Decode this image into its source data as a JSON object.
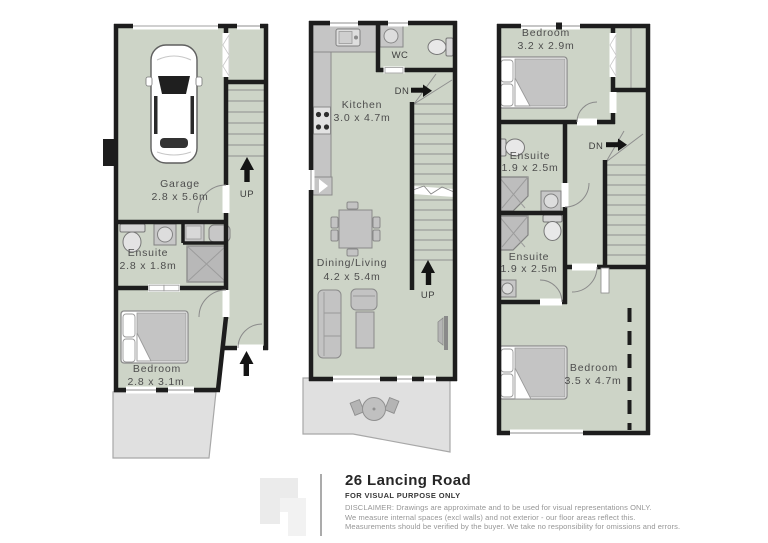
{
  "colors": {
    "room_fill": "#cdd4c7",
    "wall": "#1d1d1d",
    "deck_fill": "#e0e0e0",
    "furniture": "#c3c3c3",
    "label_text": "#4d4d4d"
  },
  "plans": {
    "ground": {
      "garage": {
        "name": "Garage",
        "dims": "2.8 x 5.6m"
      },
      "ensuite": {
        "name": "Ensuite",
        "dims": "2.8 x 1.8m"
      },
      "bedroom": {
        "name": "Bedroom",
        "dims": "2.8 x 3.1m"
      },
      "up_label": "UP"
    },
    "first": {
      "wc_label": "WC",
      "kitchen": {
        "name": "Kitchen",
        "dims": "3.0 x 4.7m"
      },
      "dining_living": {
        "name": "Dining/Living",
        "dims": "4.2 x 5.4m"
      },
      "dn_label": "DN",
      "up_label": "UP"
    },
    "second": {
      "bedroom_top": {
        "name": "Bedroom",
        "dims": "3.2 x 2.9m"
      },
      "ensuite_top": {
        "name": "Ensuite",
        "dims": "1.9 x 2.5m"
      },
      "ensuite_bottom": {
        "name": "Ensuite",
        "dims": "1.9 x 2.5m"
      },
      "bedroom_bottom": {
        "name": "Bedroom",
        "dims": "3.5 x 4.7m"
      },
      "dn_label": "DN"
    }
  },
  "footer": {
    "title": "26 Lancing Road",
    "subtitle": "FOR VISUAL PURPOSE ONLY",
    "disclaimer_lines": [
      "DISCLAIMER:  Drawings are approximate and to be used for visual representations ONLY.",
      "We measure internal spaces (excl walls) and not exterior - our floor areas reflect this.",
      "Measurements should be verified by the buyer. We take no responsibility for omissions and errors."
    ]
  }
}
